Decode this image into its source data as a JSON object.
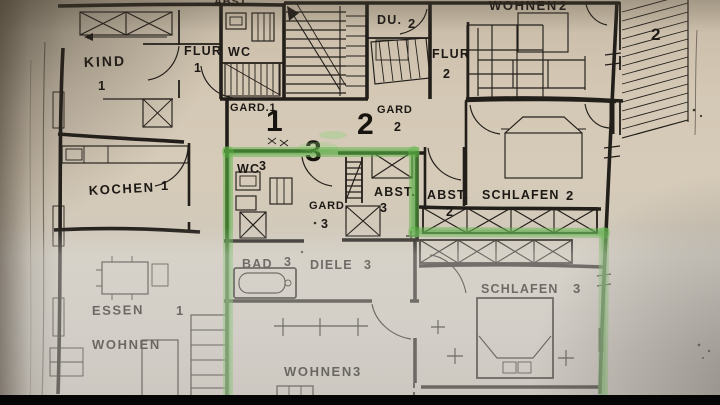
{
  "colors": {
    "highlight": "#5fb548",
    "highlight_dark": "#3f9a33",
    "paper": "#d2c6b2",
    "ink": "#221e19",
    "bottom_bar": "#050505"
  },
  "units": {
    "u1": "1",
    "u2": "2",
    "u3": "3"
  },
  "balcony": {
    "num": "2"
  },
  "rooms": {
    "abst_top": {
      "label": "ABST."
    },
    "kind": {
      "label": "KIND",
      "num": "1"
    },
    "flur1": {
      "label": "FLUR",
      "num": "1"
    },
    "wc1": {
      "label": "WC"
    },
    "gard1": {
      "label": "GARD.1"
    },
    "du2": {
      "label": "DU.",
      "num": "2"
    },
    "wohnen2": {
      "label": "WOHNEN",
      "num": "2"
    },
    "flur2": {
      "label": "FLUR",
      "num": "2"
    },
    "gard2": {
      "label": "GARD",
      "num": "2"
    },
    "kochen1": {
      "label": "KOCHEN",
      "num": "1"
    },
    "wc3": {
      "label": "WC",
      "num": "3"
    },
    "gard3": {
      "label": "GARD.",
      "num": "3"
    },
    "abst3": {
      "label": "ABST.",
      "num": "3"
    },
    "abst2": {
      "label": "ABST.",
      "num": "2"
    },
    "schlafen2": {
      "label": "SCHLAFEN",
      "num": "2"
    },
    "bad3": {
      "label": "BAD",
      "num": "3"
    },
    "diele3": {
      "label": "DIELE",
      "num": "3"
    },
    "essen1": {
      "label": "ESSEN",
      "num": "1"
    },
    "wohnen1": {
      "label": "WOHNEN"
    },
    "wohnen3": {
      "label": "WOHNEN",
      "num": "3"
    },
    "schlafen3": {
      "label": "SCHLAFEN",
      "num": "3"
    }
  }
}
